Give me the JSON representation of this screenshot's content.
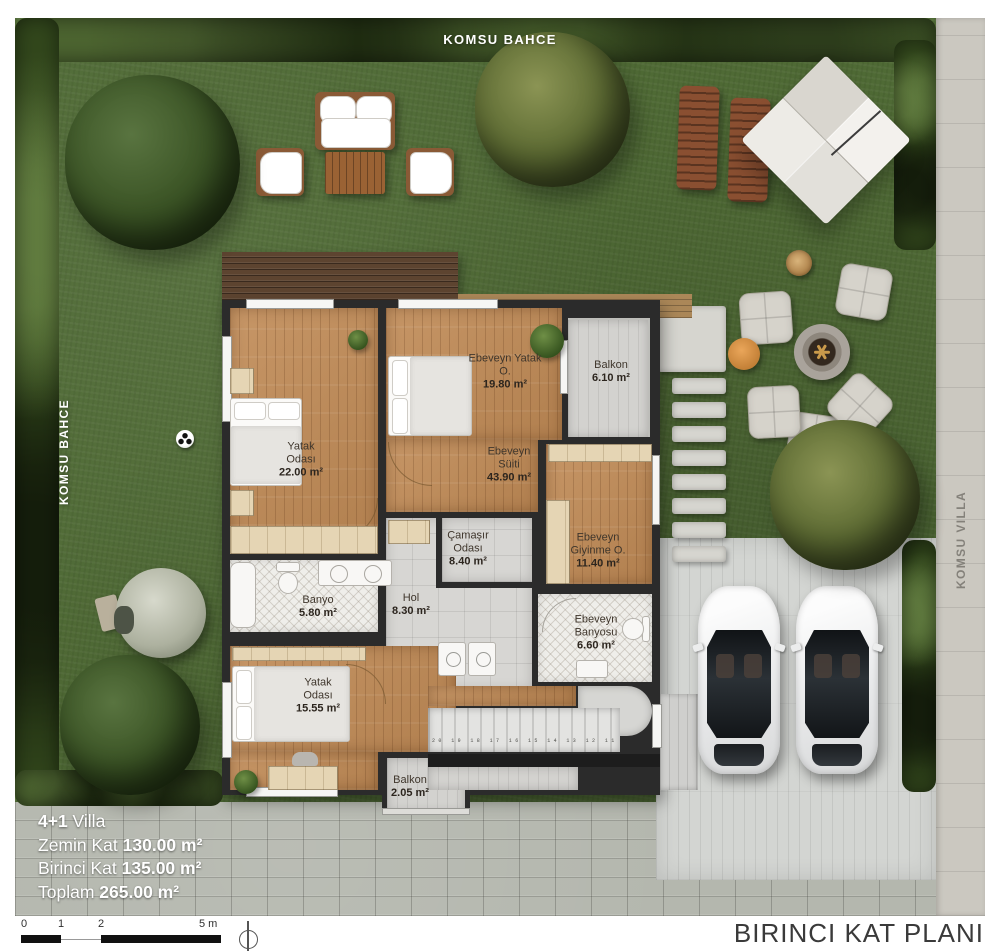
{
  "labels": {
    "neighbor_top": "KOMSU BAHCE",
    "neighbor_left": "KOMSU BAHCE",
    "neighbor_right": "KOMSU VILLA",
    "plan_title": "BIRINCI KAT PLANI"
  },
  "rooms": [
    {
      "name": "Yatak Odası",
      "area": "22.00 m²"
    },
    {
      "name": "Ebeveyn Yatak O.",
      "area": "19.80 m²"
    },
    {
      "name": "Balkon",
      "area": "6.10 m²"
    },
    {
      "name": "Ebeveyn Süiti",
      "area": "43.90 m²"
    },
    {
      "name": "Çamaşır Odası",
      "area": "8.40 m²"
    },
    {
      "name": "Ebeveyn Giyinme O.",
      "area": "11.40 m²"
    },
    {
      "name": "Banyo",
      "area": "5.80 m²"
    },
    {
      "name": "Hol",
      "area": "8.30 m²"
    },
    {
      "name": "Ebeveyn Banyosu",
      "area": "6.60 m²"
    },
    {
      "name": "Yatak Odası",
      "area": "15.55 m²"
    },
    {
      "name": "Balkon",
      "area": "2.05 m²"
    }
  ],
  "info": {
    "lines": [
      {
        "pre": "",
        "bold": "4+1",
        "post": " Villa"
      },
      {
        "pre": "Zemin Kat ",
        "bold": "130.00 m²",
        "post": ""
      },
      {
        "pre": "Birinci Kat ",
        "bold": "135.00 m²",
        "post": ""
      },
      {
        "pre": "Toplam ",
        "bold": "265.00 m²",
        "post": ""
      }
    ]
  },
  "scale": {
    "ticks": [
      "0",
      "1",
      "2",
      "5 m"
    ]
  },
  "stairs": {
    "step_numbers": "20 19 18 17 16 15 14 13 12 11 10 9 8 7 6 5"
  },
  "colors": {
    "grass": "#4f6a35",
    "hedge": "#32471c",
    "wall": "#2b2b2b",
    "wood_floor": "#c08a55",
    "tile_floor": "#d7d6d3",
    "paver": "#b4b7ae",
    "deck": "#5d4430",
    "text_white": "#ffffff",
    "title_gray": "#3a3a3a"
  }
}
